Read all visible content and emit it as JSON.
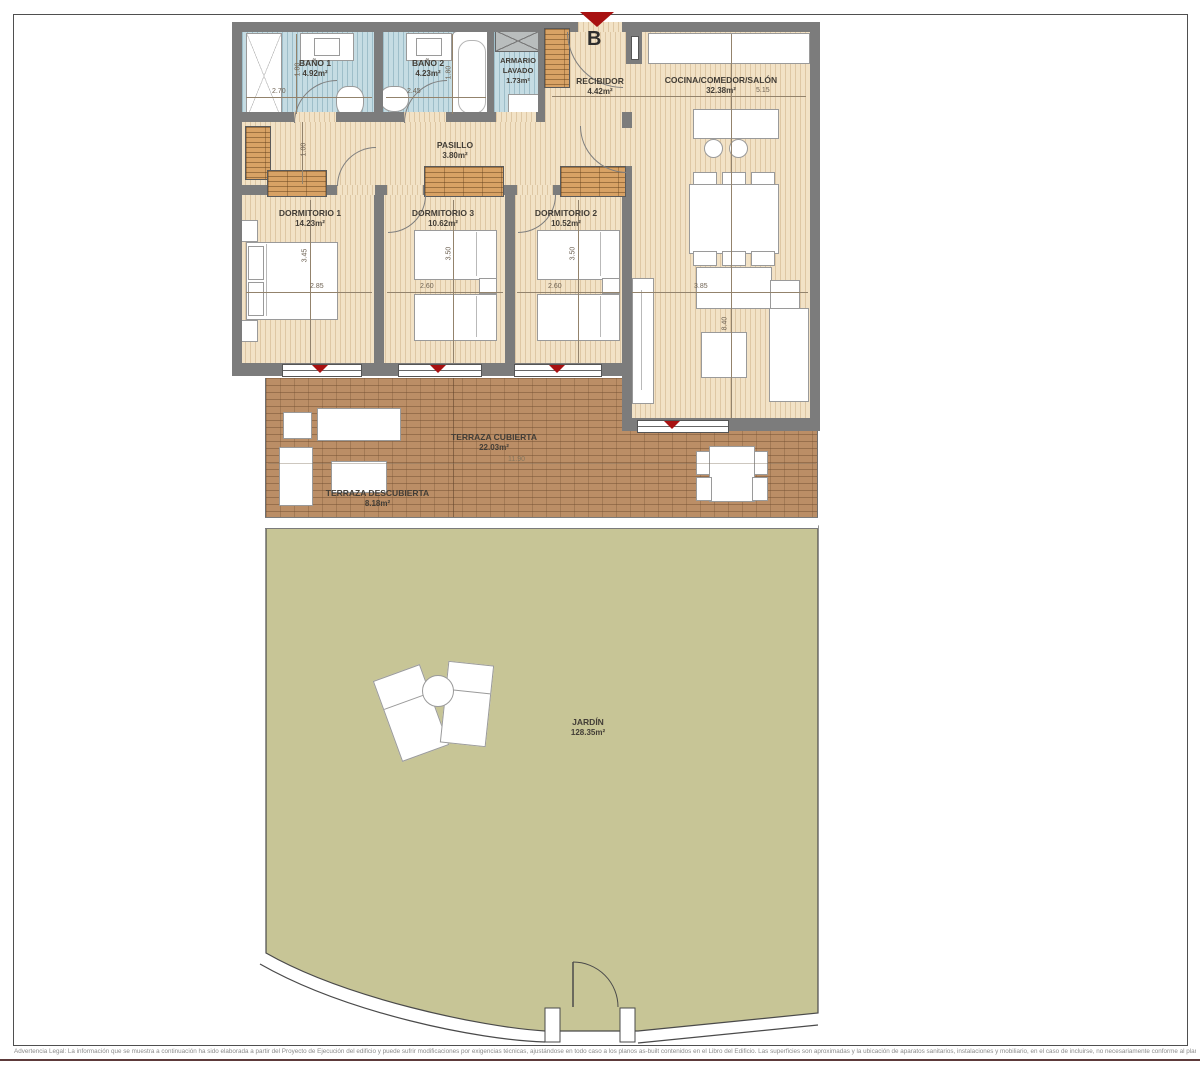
{
  "plan": {
    "entrance_marker": "B",
    "rooms": {
      "bano1": {
        "name": "BAÑO 1",
        "area": "4.92m²"
      },
      "bano2": {
        "name": "BAÑO 2",
        "area": "4.23m²"
      },
      "armario_lavado": {
        "name": "ARMARIO LAVADO",
        "area": "1.73m²"
      },
      "recibidor": {
        "name": "RECIBIDOR",
        "area": "4.42m²"
      },
      "cocina": {
        "name": "COCINA/COMEDOR/SALÓN",
        "area": "32.38m²"
      },
      "pasillo": {
        "name": "PASILLO",
        "area": "3.80m²"
      },
      "dormitorio1": {
        "name": "DORMITORIO 1",
        "area": "14.23m²"
      },
      "dormitorio3": {
        "name": "DORMITORIO 3",
        "area": "10.62m²"
      },
      "dormitorio2": {
        "name": "DORMITORIO 2",
        "area": "10.52m²"
      },
      "terraza_cubierta": {
        "name": "TERRAZA CUBIERTA",
        "area": "22.03m²"
      },
      "terraza_descubierta": {
        "name": "TERRAZA DESCUBIERTA",
        "area": "8.18m²"
      },
      "jardin": {
        "name": "JARDÍN",
        "area": "128.35m²"
      }
    },
    "dims": {
      "bano1_w": "2.70",
      "bano1_h": "1.80",
      "bano2_w": "2.45",
      "bano2_h": "1.80",
      "cocina_w": "5.15",
      "pasillo_h": "1.00",
      "dorm1_h": "3.45",
      "dorm1_w": "2.85",
      "dorm3_h": "3.50",
      "dorm3_w": "2.60",
      "dorm2_h": "3.50",
      "dorm2_w": "2.60",
      "salon_w": "3.85",
      "salon_h": "8.40",
      "terraza_w": "11.90"
    },
    "colors": {
      "accent_red": "#a81111",
      "floor_beige": "#f2e2c6",
      "bath_blue": "#c5dce3",
      "terrace_brick": "#bb8e66",
      "garden_green": "#c7c596",
      "wall_gray": "#7c7c7c"
    }
  },
  "footer": {
    "legal": "Advertencia Legal: La información que se muestra a continuación ha sido elaborada a partir del Proyecto de Ejecución del edificio y puede sufrir modificaciones por exigencias técnicas, ajustándose en todo caso a los planos as-built contenidos en el Libro del Edificio. Las superficies son aproximadas y la ubicación de aparatos sanitarios, instalaciones y mobiliario, en el caso de incluirse, no necesariamente conforme al plano. Consulte en el punto de venta"
  }
}
